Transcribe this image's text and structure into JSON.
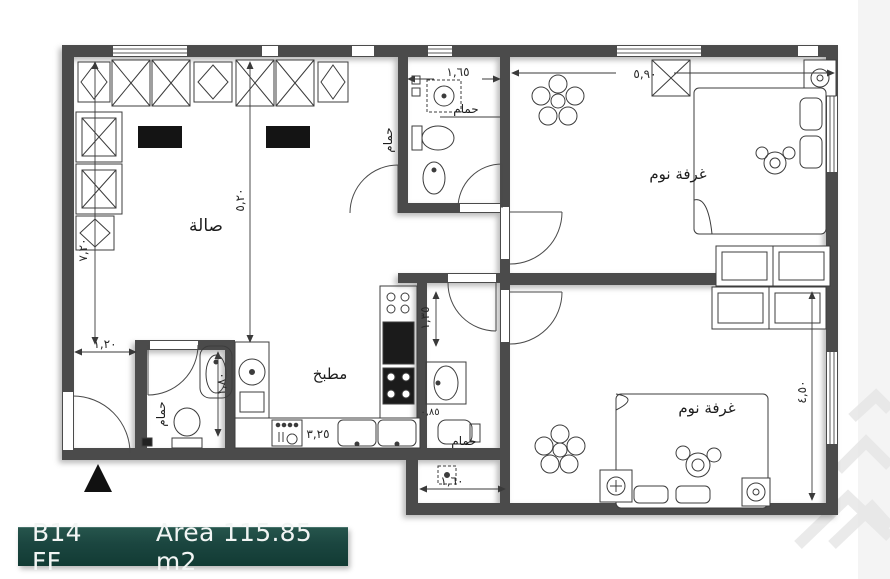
{
  "title_bar": {
    "unit_code": "B14 FF",
    "area_label": "Area 115.85 m2"
  },
  "colors": {
    "wall": "#4c4c4c",
    "drawing_line": "#3c3c3c",
    "furniture_fill": "#141414",
    "footer_background": "#1b4640",
    "footer_text": "#f2f5f4"
  },
  "rooms": {
    "hall": {
      "label": "صالة"
    },
    "kitchen": {
      "label": "مطبخ"
    },
    "bedroom_top": {
      "label": "غرفة نوم"
    },
    "bedroom_bottom": {
      "label": "غرفة نوم"
    },
    "bath_top": {
      "label": "حمام"
    },
    "bath_middle": {
      "label": "حمام"
    },
    "bath_entry": {
      "label": "حمام"
    }
  },
  "dimensions": {
    "bedroom_top_width": "٥,٩٠",
    "bath_top_width": "١,٦٥",
    "hall_height": "٧,٢٠",
    "hall_inner": "٥,٢٠",
    "entry_width": "١,٢٠",
    "kitchen_width": "٣,٢٥",
    "bath_middle_height": "١,٣٥",
    "bath_middle_width": "١,٦٠",
    "bedroom_bottom_height": "٤,٥٠",
    "bath_entry_depth": "١,٨٠",
    "bath_middle_offset": "٠,٨٥"
  }
}
